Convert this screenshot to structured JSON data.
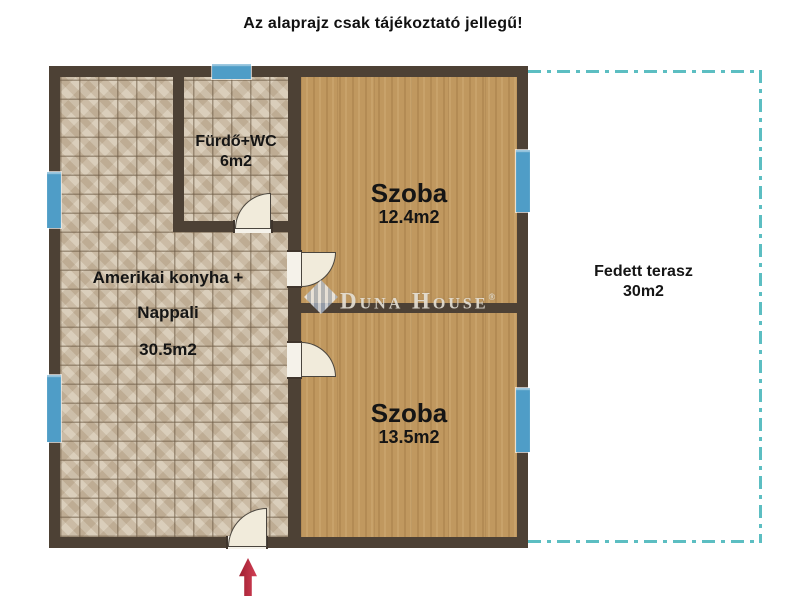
{
  "title": "Az alaprajz csak tájékoztató jellegű!",
  "watermark": {
    "brand": "Duna House",
    "registered": "®"
  },
  "rooms": {
    "living": {
      "line1": "Amerikai konyha +",
      "line2": "Nappali",
      "area": "30.5m2"
    },
    "bathroom": {
      "name": "Fürdő+WC",
      "area": "6m2"
    },
    "bedroom1": {
      "name": "Szoba",
      "area": "12.4m2"
    },
    "bedroom2": {
      "name": "Szoba",
      "area": "13.5m2"
    },
    "terrace": {
      "name": "Fedett terasz",
      "area": "30m2"
    }
  },
  "colors": {
    "wall": "#4d4135",
    "tile_floor": "#d0c2ab",
    "wood_floor": "#c0985f",
    "window": "#4f9dc7",
    "door": "#f1ebdb",
    "terrace_dash": "#5cbec2",
    "entrance_arrow": "#c12739"
  }
}
